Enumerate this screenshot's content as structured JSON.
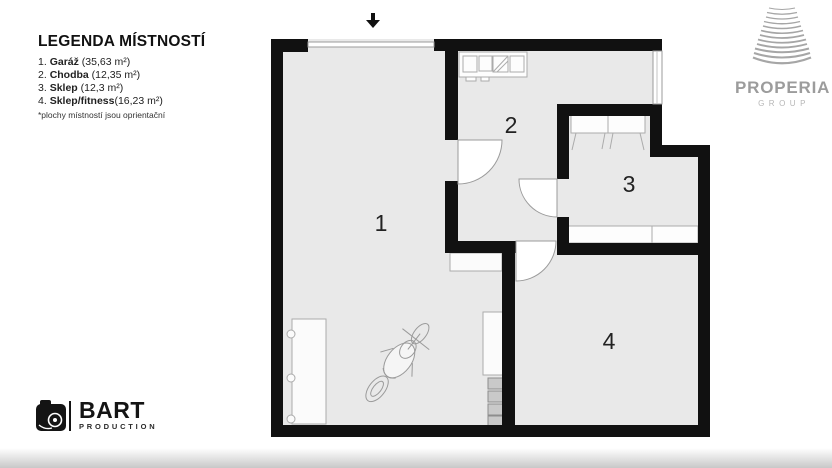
{
  "legend": {
    "title": "LEGENDA MÍSTNOSTÍ",
    "items": [
      {
        "num": "1.",
        "name": "Garáž",
        "area": " (35,63 m²)"
      },
      {
        "num": "2.",
        "name": "Chodba",
        "area": " (12,35 m²)"
      },
      {
        "num": "3.",
        "name": "Sklep",
        "area": " (12,3 m²)"
      },
      {
        "num": "4.",
        "name": "Sklep/fitness",
        "area": "(16,23 m²)"
      }
    ],
    "note": "*plochy místností jsou oprientační"
  },
  "plan": {
    "room_numbers": [
      "1",
      "2",
      "3",
      "4"
    ]
  },
  "logos": {
    "properia": {
      "name": "PROPERIA",
      "sub": "GROUP"
    },
    "bart": {
      "name": "BART",
      "sub": "PRODUCTION"
    }
  },
  "colors": {
    "wall": "#111111",
    "floor": "#e9e9e9",
    "furniture_stroke": "#ababab",
    "logo_gray": "#9c9c9c"
  }
}
